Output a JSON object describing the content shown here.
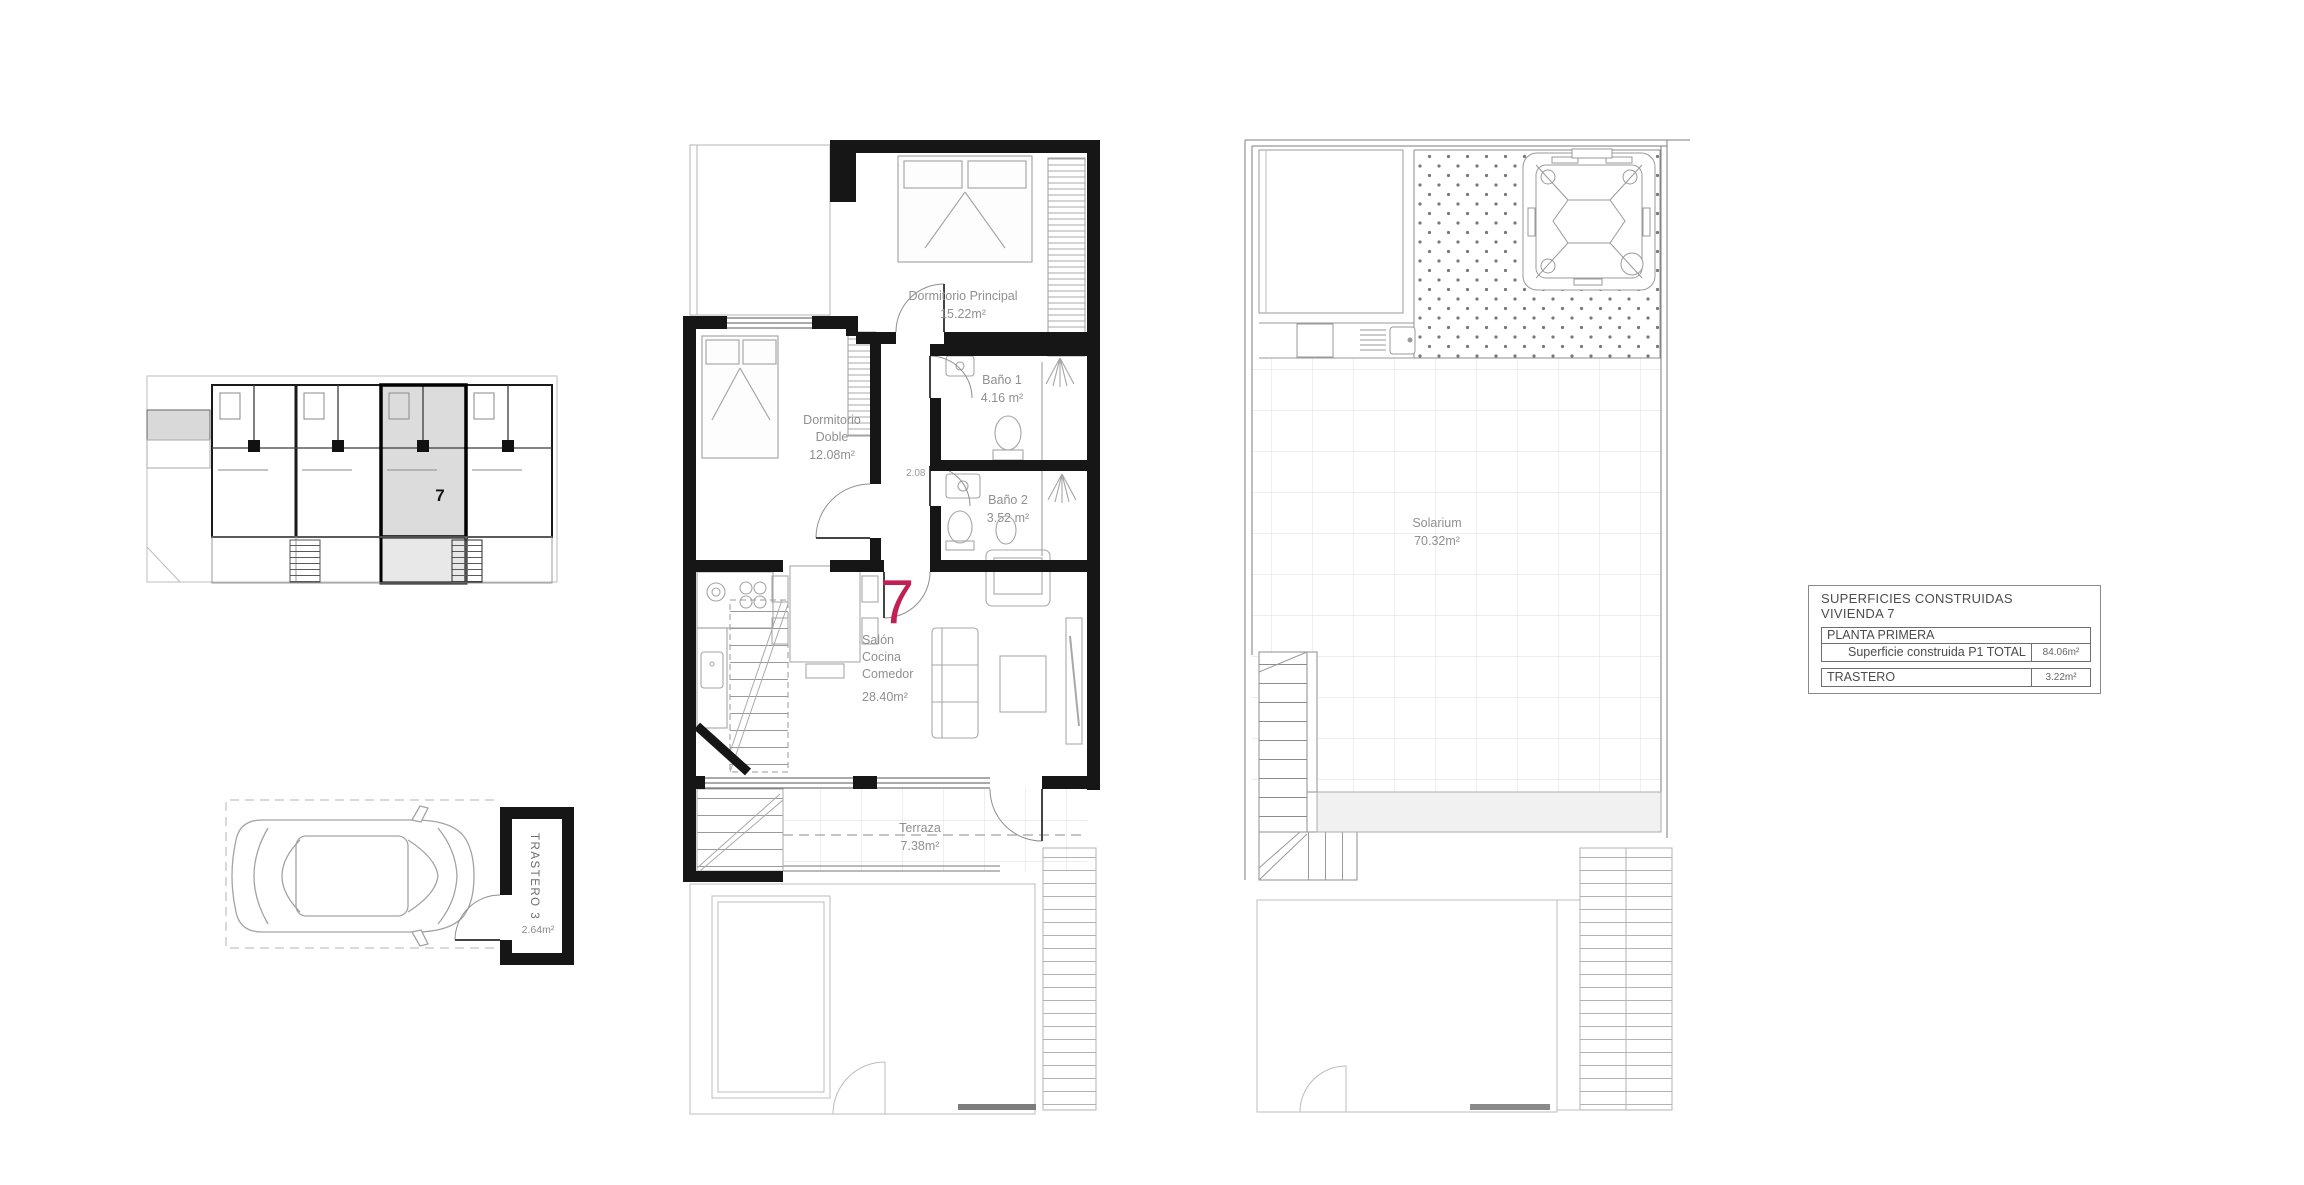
{
  "page": {
    "background": "#ffffff",
    "label_color": "#909090",
    "wall_color": "#161616",
    "accent_red": "#c22055"
  },
  "key_plan": {
    "unit_label": "7"
  },
  "garage_plan": {
    "trastero_label": "TRASTERO 3",
    "trastero_area": "2.64m²"
  },
  "main_plan": {
    "unit_number": "7",
    "dimension": "2.08",
    "dorm_principal": {
      "name": "Dormitorio Principal",
      "area": "15.22m²"
    },
    "dorm_doble": {
      "line1": "Dormitorio",
      "line2": "Doble",
      "area": "12.08m²"
    },
    "bano1": {
      "name": "Baño 1",
      "area": "4.16 m²"
    },
    "bano2": {
      "name": "Baño 2",
      "area": "3.52 m²"
    },
    "salon": {
      "line1": "Salón",
      "line2": "Cocina",
      "line3": "Comedor",
      "area": "28.40m²"
    },
    "terraza": {
      "name": "Terraza",
      "area": "7.38m²"
    }
  },
  "roof_plan": {
    "solarium": {
      "name": "Solarium",
      "area": "70.32m²"
    }
  },
  "legend": {
    "title_line1": "SUPERFICIES CONSTRUIDAS",
    "title_line2": "VIVIENDA 7",
    "planta_header": "PLANTA PRIMERA",
    "p1_label": "Superficie construida P1 TOTAL",
    "p1_value": "84.06m²",
    "trastero_label": "TRASTERO",
    "trastero_value": "3.22m²"
  }
}
